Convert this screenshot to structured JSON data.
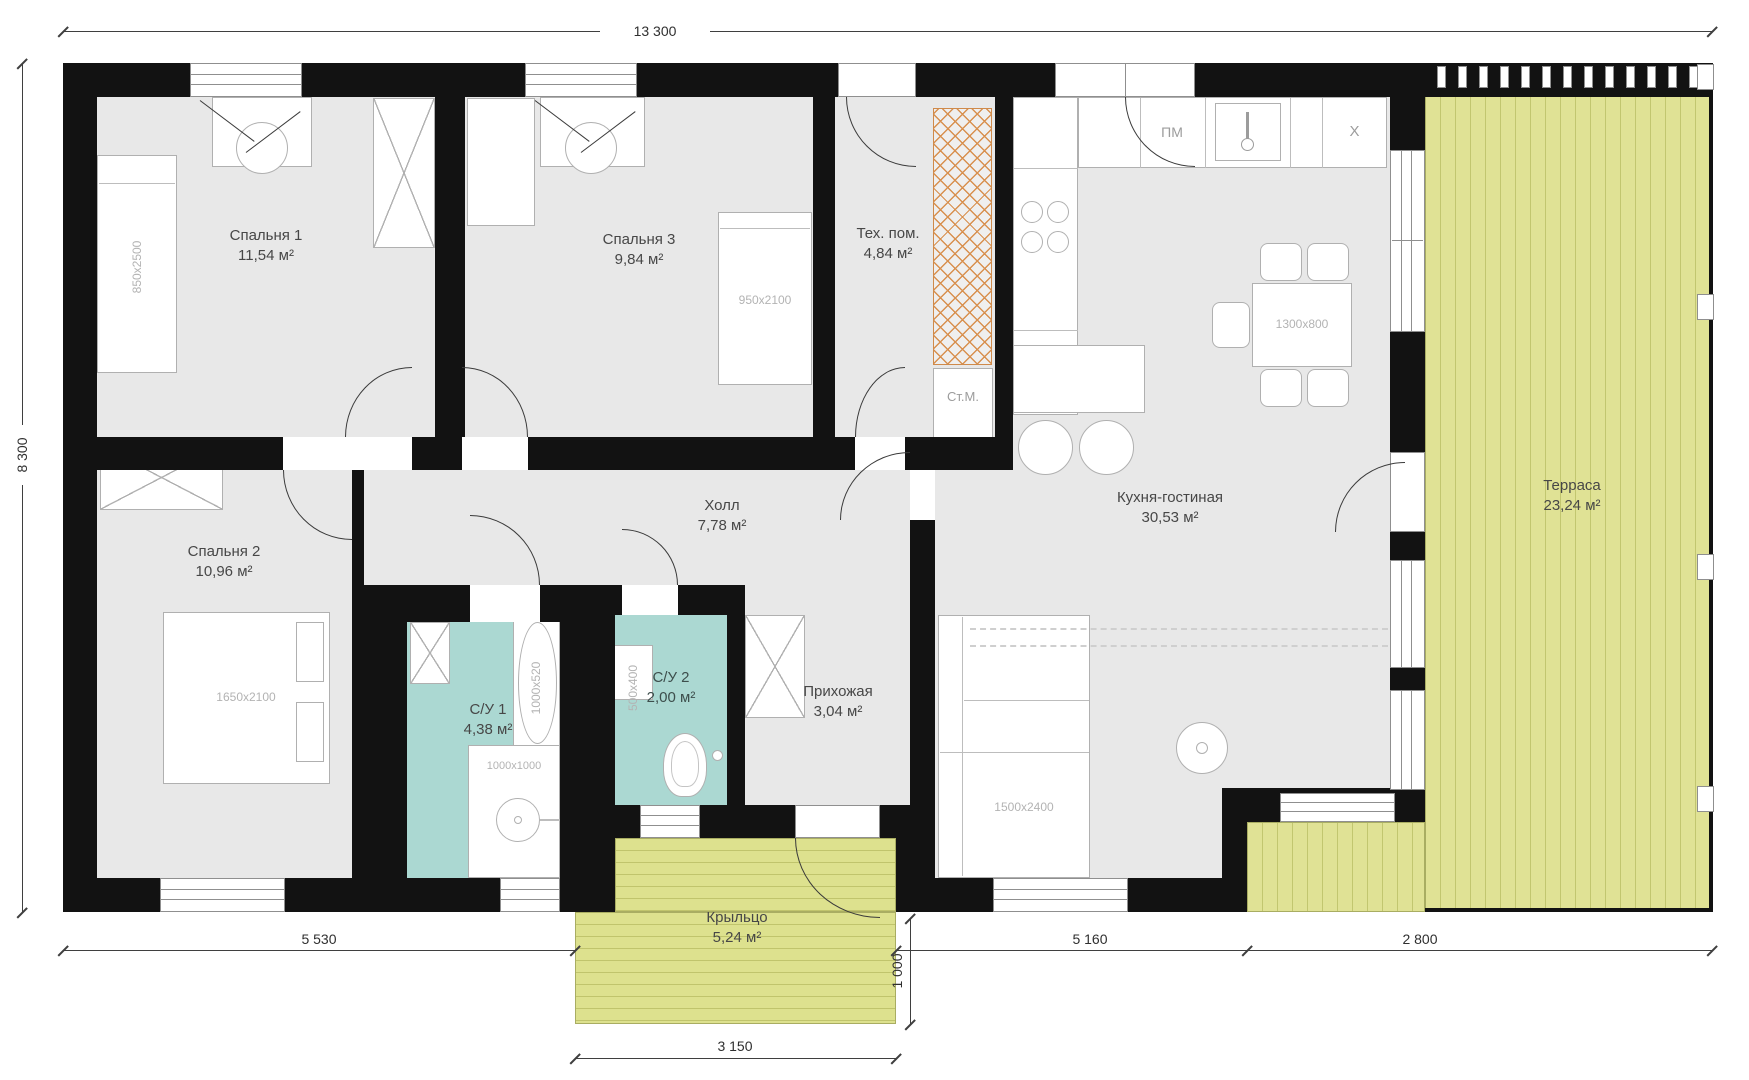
{
  "rooms": {
    "bedroom1": {
      "name": "Спальня 1",
      "area": "11,54 м²"
    },
    "bedroom2": {
      "name": "Спальня 2",
      "area": "10,96 м²"
    },
    "bedroom3": {
      "name": "Спальня 3",
      "area": "9,84 м²"
    },
    "tech_room": {
      "name": "Тех. пом.",
      "area": "4,84 м²"
    },
    "kitchen_living": {
      "name": "Кухня-гостиная",
      "area": "30,53 м²"
    },
    "hall": {
      "name": "Холл",
      "area": "7,78 м²"
    },
    "entry": {
      "name": "Прихожая",
      "area": "3,04 м²"
    },
    "bathroom1": {
      "name": "С/У 1",
      "area": "4,38 м²"
    },
    "bathroom2": {
      "name": "С/У 2",
      "area": "2,00 м²"
    },
    "terrace": {
      "name": "Терраса",
      "area": "23,24 м²"
    },
    "porch": {
      "name": "Крыльцо",
      "area": "5,24 м²"
    }
  },
  "furniture": {
    "bed1_size": "850x2500",
    "bed2_size": "1650x2100",
    "bed3_size": "950x2100",
    "dining_table_size": "1300x800",
    "sofa_size": "1500x2400",
    "bathtub_size": "1000x520",
    "shower_size": "1000x1000",
    "sink_size": "500x400",
    "washing_machine": "Ст.М.",
    "dishwasher": "ПМ",
    "fridge": "X"
  },
  "dimensions": {
    "total_width": "13 300",
    "total_depth": "8 300",
    "bottom_left": "5 530",
    "bottom_middle": "5 160",
    "bottom_right": "2 800",
    "porch_width": "3 150",
    "porch_depth": "1 000"
  },
  "colors": {
    "wall": "#121212",
    "floor": "#e8e8e8",
    "bathroom_floor": "#abd8d2",
    "terrace_deck": "#e0e295",
    "porch_deck": "#dde18e",
    "tech_hatch": "#d8904f"
  }
}
